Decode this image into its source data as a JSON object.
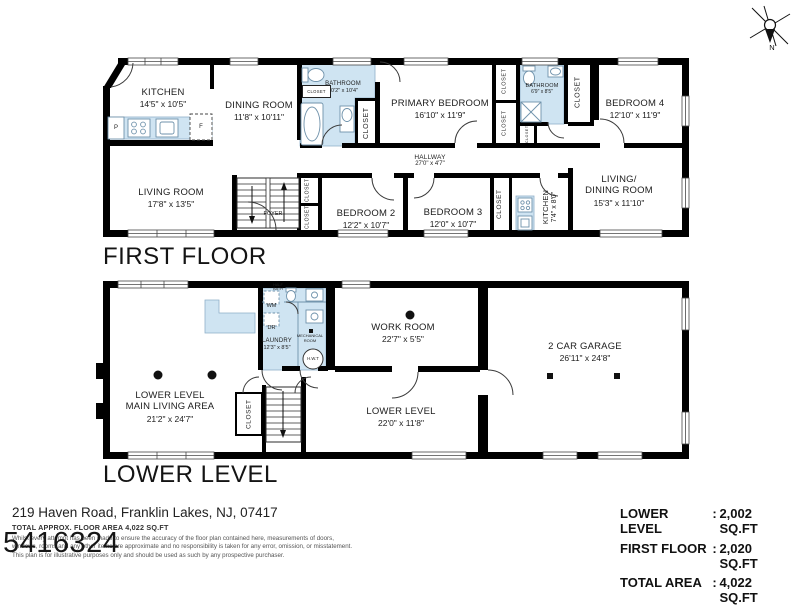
{
  "colors": {
    "wall": "#000000",
    "wet_area": "#cfe4f2"
  },
  "compass": {
    "n": "N"
  },
  "first_floor": {
    "title": "FIRST FLOOR",
    "rooms": {
      "kitchen": {
        "name": "KITCHEN",
        "dims": "14'5\" x 10'5\""
      },
      "dining": {
        "name": "DINING ROOM",
        "dims": "11'8\" x 10'11\""
      },
      "bathroom1": {
        "name": "BATHROOM",
        "dims": "10'2\" x 10'4\""
      },
      "primary": {
        "name": "PRIMARY BEDROOM",
        "dims": "16'10\" x 11'9\""
      },
      "bathroom2": {
        "name": "BATHROOM",
        "dims": "6'9\" x 8'5\""
      },
      "bedroom4": {
        "name": "BEDROOM 4",
        "dims": "12'10\" x 11'9\""
      },
      "living": {
        "name": "LIVING ROOM",
        "dims": "17'8\" x 13'5\""
      },
      "foyer": {
        "name": "FOYER"
      },
      "hallway": {
        "name": "HALLWAY",
        "dims": "27'0\" x 4'7\""
      },
      "bedroom2": {
        "name": "BEDROOM 2",
        "dims": "12'2\" x 10'7\""
      },
      "bedroom3": {
        "name": "BEDROOM 3",
        "dims": "12'0\" x 10'7\""
      },
      "kitchen2": {
        "name": "KITCHEN",
        "dims": "7'4\" x 8'0\""
      },
      "livingdining": {
        "name": "LIVING/\nDINING ROOM",
        "dims": "15'3\" x 11'10\""
      }
    }
  },
  "lower_level": {
    "title": "LOWER LEVEL",
    "rooms": {
      "main": {
        "name": "LOWER LEVEL\nMAIN LIVING AREA",
        "dims": "21'2\" x 24'7\""
      },
      "laundry": {
        "name": "LAUNDRY",
        "dims": "12'3\" x 8'5\""
      },
      "halfbath": {
        "name": "HALF\nBATH"
      },
      "mechanical": {
        "name": "MECHANICAL\nROOM"
      },
      "workroom": {
        "name": "WORK ROOM",
        "dims": "22'7\" x 5'5\""
      },
      "garage": {
        "name": "2 CAR GARAGE",
        "dims": "26'11\" x 24'8\""
      },
      "lower": {
        "name": "LOWER LEVEL",
        "dims": "22'0\" x 11'8\""
      }
    }
  },
  "labels": {
    "closet": "CLOSET",
    "wm": "WM",
    "dr": "DR",
    "hwt": "H.W.T",
    "pantry": "P",
    "fridge": "F"
  },
  "footer": {
    "address": "219 Haven Road, Franklin Lakes, NJ, 07417",
    "approx_area": "TOTAL APPROX. FLOOR AREA 4,022 SQ.FT",
    "disclaimer": [
      "Whilst every attempt has been made to ensure the accuracy of the floor plan contained here, measurements of doors,",
      "windows, rooms and any other items are approximate and no responsibility is taken for any error, omission, or misstatement.",
      "This plan is for illustrative purposes only and should be used as such by any prospective purchaser."
    ],
    "watermark": "5416324"
  },
  "summary": {
    "sep": ":",
    "rows": [
      {
        "label": "LOWER LEVEL",
        "value": "2,002 SQ.FT"
      },
      {
        "label": "FIRST FLOOR",
        "value": "2,020 SQ.FT"
      },
      {
        "label": "TOTAL AREA",
        "value": "4,022 SQ.FT"
      }
    ]
  }
}
